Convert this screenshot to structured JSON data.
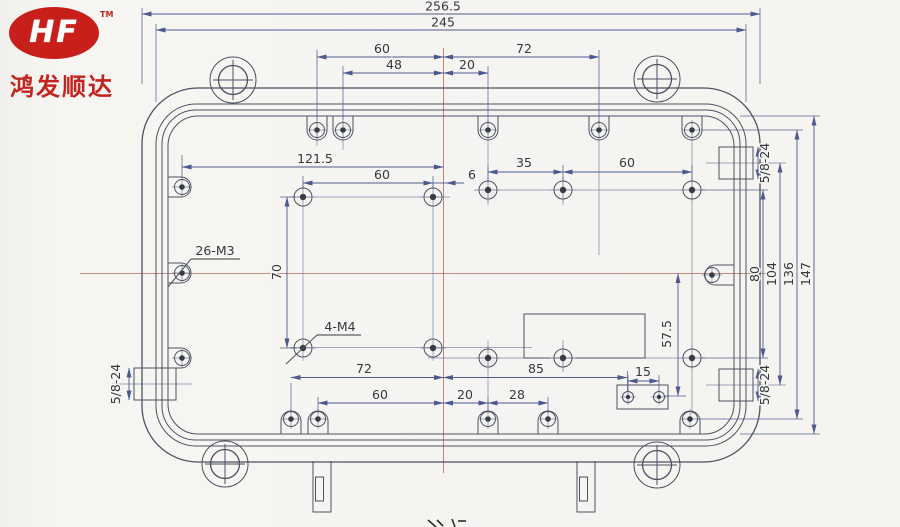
{
  "logo": {
    "brand": "HF",
    "trademark": "TM",
    "company": "鸿发顺达",
    "brand_color": "#c81f1a"
  },
  "drawing": {
    "type": "mechanical-enclosure-dimension-drawing",
    "dimensions": {
      "overall_width": "256.5",
      "inner_width": "245",
      "top_left_60": "60",
      "top_right_72": "72",
      "top_48": "48",
      "top_20": "20",
      "mid_121_5": "121.5",
      "mid_60": "60",
      "mid_6": "6",
      "upper_right_35": "35",
      "upper_right_60": "60",
      "left_height_70": "70",
      "right_80": "80",
      "right_104": "104",
      "right_136": "136",
      "right_147": "147",
      "mid_57_5": "57.5",
      "bottom_72": "72",
      "bottom_85": "85",
      "bottom_60": "60",
      "bottom_20": "20",
      "bottom_28": "28",
      "bottom_15": "15"
    },
    "labels": {
      "holes_26_m3": "26-M3",
      "holes_4_m4": "4-M4",
      "thread_top_right": "5/8-24",
      "thread_bottom_left": "5/8-24",
      "thread_bottom_right": "5/8-24"
    }
  }
}
